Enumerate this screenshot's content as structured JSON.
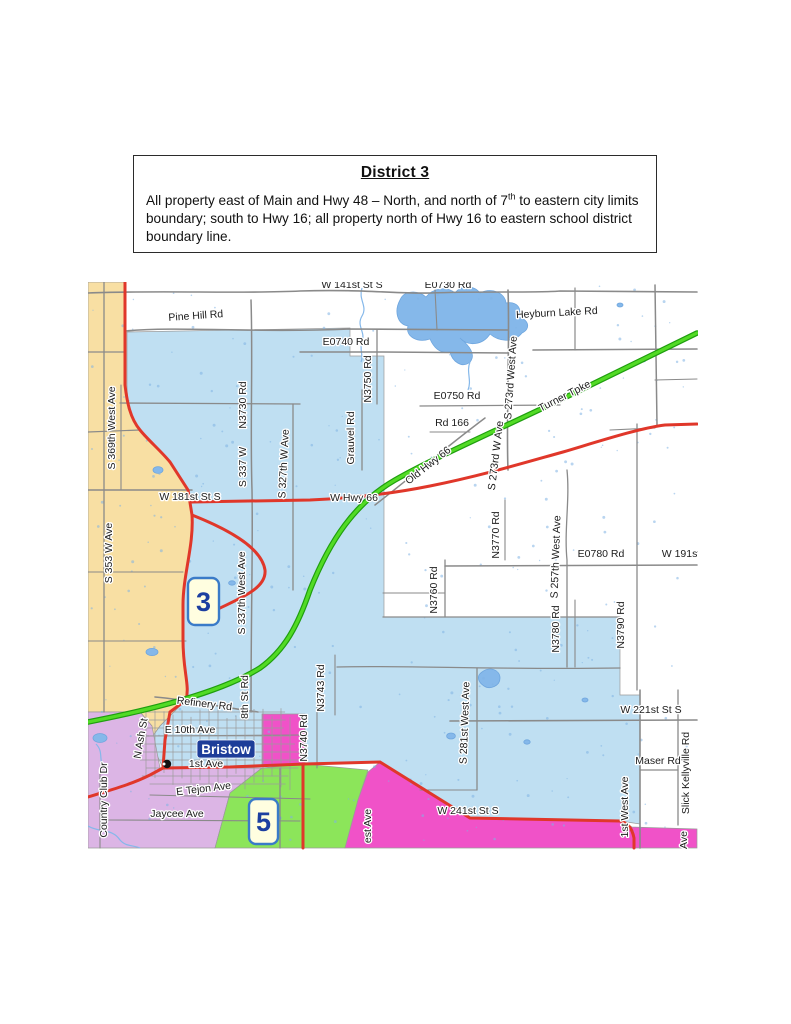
{
  "header": {
    "title": "District 3",
    "body_pre": "All property east of Main and Hwy 48 – North, and north of 7",
    "body_sup": "th",
    "body_post": " to eastern city limits boundary; south to Hwy 16; all property north of Hwy 16 to eastern school district boundary line."
  },
  "map": {
    "city": {
      "name": "Bristow"
    },
    "badges": [
      {
        "n": "3",
        "x": 188,
        "y": 578,
        "w": 31,
        "h": 47
      },
      {
        "n": "5",
        "x": 249,
        "y": 799,
        "w": 29,
        "h": 45
      }
    ],
    "colors": {
      "district3_fill": "#BFDFF2",
      "tan_region": "#F8DFA3",
      "purple_region": "#DCB5E5",
      "green_region": "#8CE55A",
      "magenta_region": "#F052C8",
      "lake": "#85B8EA",
      "highway_red": "#E0372A",
      "turnpike_green": "#52DB25",
      "road_gray": "#8A8A8A",
      "badge_fill": "#FFFEE0",
      "badge_border": "#3A7BC8",
      "city_badge": "#1D3D99"
    },
    "labels": [
      {
        "t": "W 141st St S",
        "x": 352,
        "y": 288,
        "r": 0
      },
      {
        "t": "E0730 Rd",
        "x": 448,
        "y": 288,
        "r": 0
      },
      {
        "t": "Pine Hill Rd",
        "x": 196,
        "y": 319,
        "r": -4,
        "s": 11.5
      },
      {
        "t": "Heyburn Lake Rd",
        "x": 557,
        "y": 316,
        "r": -3,
        "s": 11
      },
      {
        "t": "E0740 Rd",
        "x": 346,
        "y": 345,
        "r": 0,
        "s": 11
      },
      {
        "t": "N3750 Rd",
        "x": 371,
        "y": 379,
        "r": -90
      },
      {
        "t": "Grauvel Rd",
        "x": 354,
        "y": 438,
        "r": -90
      },
      {
        "t": "E0750 Rd",
        "x": 457,
        "y": 399,
        "r": 0,
        "s": 11
      },
      {
        "t": "Rd 166",
        "x": 452,
        "y": 426,
        "r": 0
      },
      {
        "t": "S 273rd West Ave",
        "x": 514,
        "y": 378,
        "r": -86
      },
      {
        "t": "S 273rd W Ave",
        "x": 499,
        "y": 456,
        "r": -83
      },
      {
        "t": "Old Hwy 66",
        "x": 430,
        "y": 468,
        "r": -38
      },
      {
        "t": "Turner Tpke",
        "x": 566,
        "y": 399,
        "r": -27,
        "s": 11.5
      },
      {
        "t": "N3730 Rd",
        "x": 246,
        "y": 405,
        "r": -90
      },
      {
        "t": "W 181st St S",
        "x": 190,
        "y": 500,
        "r": 0,
        "s": 11
      },
      {
        "t": "S 337 W",
        "x": 246,
        "y": 467,
        "r": -90
      },
      {
        "t": "S 327th W Ave",
        "x": 287,
        "y": 464,
        "r": -87
      },
      {
        "t": "W Hwy 66",
        "x": 354,
        "y": 501,
        "r": 0,
        "s": 11.5
      },
      {
        "t": "S 353 W Ave",
        "x": 112,
        "y": 553,
        "r": -90
      },
      {
        "t": "S 369th West Ave",
        "x": 115,
        "y": 428,
        "r": -90
      },
      {
        "t": "S 337th West Ave",
        "x": 245,
        "y": 593,
        "r": -90
      },
      {
        "t": "N3770 Rd",
        "x": 499,
        "y": 535,
        "r": -90
      },
      {
        "t": "S 257th West Ave",
        "x": 559,
        "y": 557,
        "r": -88
      },
      {
        "t": "E0780 Rd",
        "x": 601,
        "y": 557,
        "r": 0,
        "s": 11
      },
      {
        "t": "W 191st",
        "x": 681,
        "y": 557,
        "r": 0,
        "s": 11
      },
      {
        "t": "N3760 Rd",
        "x": 437,
        "y": 590,
        "r": -90
      },
      {
        "t": "N3780 Rd",
        "x": 559,
        "y": 629,
        "r": -90
      },
      {
        "t": "N3790 Rd",
        "x": 624,
        "y": 625,
        "r": -90
      },
      {
        "t": "N3743 Rd",
        "x": 324,
        "y": 688,
        "r": -90
      },
      {
        "t": "Refinery Rd",
        "x": 204,
        "y": 707,
        "r": 7,
        "s": 11
      },
      {
        "t": "8th St Rd",
        "x": 248,
        "y": 697,
        "r": -90
      },
      {
        "t": "N3740 Rd",
        "x": 307,
        "y": 738,
        "r": -90
      },
      {
        "t": "S 281st West Ave",
        "x": 468,
        "y": 723,
        "r": -88
      },
      {
        "t": "W 221st St S",
        "x": 651,
        "y": 713,
        "r": 0,
        "s": 11
      },
      {
        "t": "Maser Rd",
        "x": 658,
        "y": 764,
        "r": 0,
        "s": 11
      },
      {
        "t": "Slick Kellyville Rd",
        "x": 689,
        "y": 773,
        "r": -90
      },
      {
        "t": "E 10th Ave",
        "x": 190,
        "y": 733,
        "r": 0
      },
      {
        "t": "1st Ave",
        "x": 206,
        "y": 767,
        "r": 0
      },
      {
        "t": "E Tejon Ave",
        "x": 204,
        "y": 792,
        "r": -7,
        "s": 11
      },
      {
        "t": "Jaycee Ave",
        "x": 177,
        "y": 817,
        "r": 0,
        "s": 11
      },
      {
        "t": "N Ash St",
        "x": 144,
        "y": 739,
        "r": -80
      },
      {
        "t": "Country Club Dr",
        "x": 107,
        "y": 800,
        "r": -90
      },
      {
        "t": "1st West Ave",
        "x": 628,
        "y": 807,
        "r": -90
      },
      {
        "t": "W 241st St S",
        "x": 468,
        "y": 814,
        "r": 0,
        "s": 11
      },
      {
        "t": "est Ave",
        "x": 371,
        "y": 826,
        "r": -90
      },
      {
        "t": "Ave",
        "x": 687,
        "y": 840,
        "r": -90
      }
    ]
  }
}
